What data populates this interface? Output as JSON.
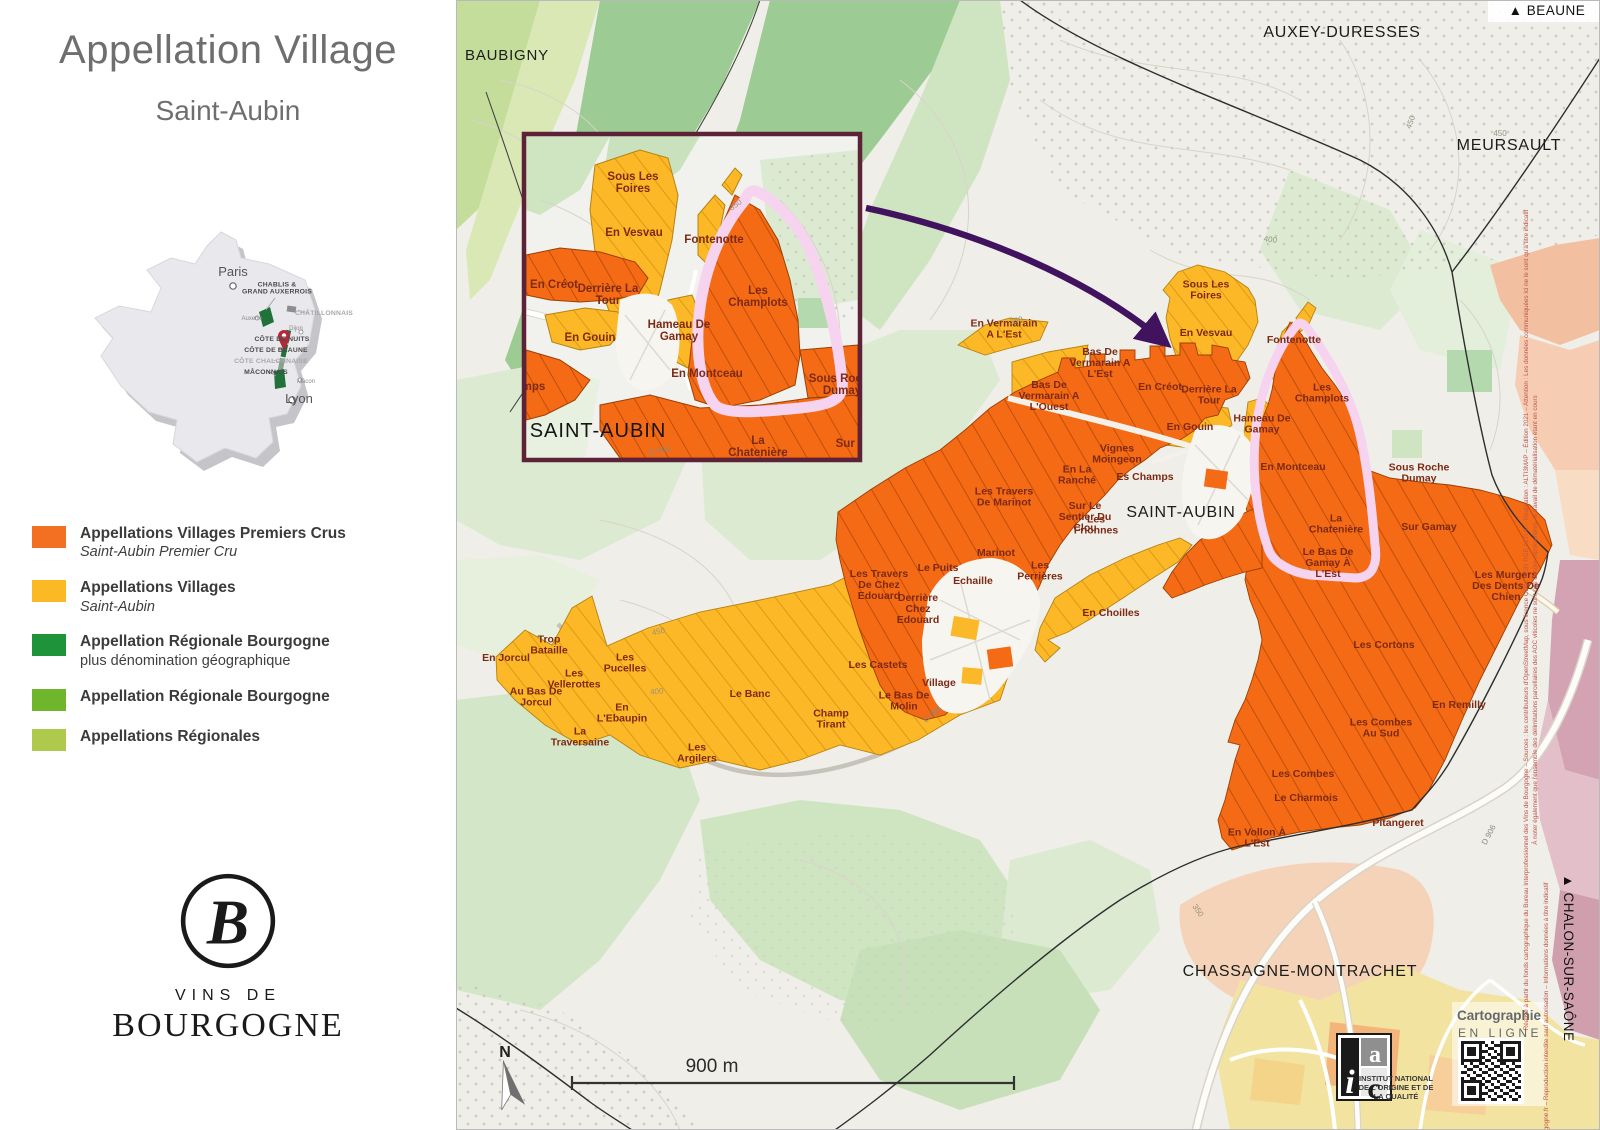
{
  "panel": {
    "title": "Appellation Village",
    "subtitle": "Saint-Aubin",
    "legend": [
      {
        "color": "#f36f21",
        "label": "Appellations Villages Premiers Crus",
        "sublabel": "Saint-Aubin Premier Cru"
      },
      {
        "color": "#fbba25",
        "label": "Appellations Villages",
        "sublabel": "Saint-Aubin"
      },
      {
        "color": "#1f9339",
        "label": "Appellation Régionale Bourgogne",
        "sublabel": "plus dénomination géographique"
      },
      {
        "color": "#70b62c",
        "label": "Appellation Régionale Bourgogne"
      },
      {
        "color": "#afc94c",
        "label": "Appellations Régionales"
      }
    ],
    "logo": {
      "initial": "B",
      "line1": "VINS DE",
      "line2": "BOURGOGNE"
    },
    "france": {
      "labels": [
        {
          "t": "Paris",
          "x": 160,
          "y": 58,
          "c": "fr-city"
        },
        {
          "t": "Lyon",
          "x": 226,
          "y": 185,
          "c": "fr-city",
          "a": "start"
        },
        {
          "t": "CHABLIS &\nGRAND AUXERROIS",
          "x": 204,
          "y": 72,
          "c": "fr-region"
        },
        {
          "t": "CHÂTILLONNAIS",
          "x": 251,
          "y": 97,
          "c": "fr-region fr-muted"
        },
        {
          "t": "Auxerre",
          "x": 179,
          "y": 102,
          "c": "fr-town",
          "a": "end"
        },
        {
          "t": "Dijon",
          "x": 223,
          "y": 112,
          "c": "fr-town",
          "a": "end"
        },
        {
          "t": "CÔTE DE NUITS",
          "x": 209,
          "y": 123,
          "c": "fr-region",
          "a": "end"
        },
        {
          "t": "CÔTE DE BEAUNE",
          "x": 203,
          "y": 134,
          "c": "fr-region",
          "a": "end"
        },
        {
          "t": "CÔTE CHALONNAISE",
          "x": 198,
          "y": 145,
          "c": "fr-region fr-muted",
          "a": "end"
        },
        {
          "t": "MÂCONNAIS",
          "x": 193,
          "y": 156,
          "c": "fr-region",
          "a": "end"
        },
        {
          "t": "Mâcon",
          "x": 233,
          "y": 165,
          "c": "fr-town",
          "a": "start"
        }
      ]
    }
  },
  "map": {
    "labels": [
      {
        "t": "BAUBIGNY",
        "x": 507,
        "y": 60,
        "c": "commune commune-sm"
      },
      {
        "t": "AUXEY-DURESSES",
        "x": 1342,
        "y": 37,
        "c": "commune"
      },
      {
        "t": "MEURSAULT",
        "x": 1509,
        "y": 150,
        "c": "commune"
      },
      {
        "t": "SAINT-AUBIN",
        "x": 1181,
        "y": 517,
        "c": "commune"
      },
      {
        "t": "CHASSAGNE-MONTRACHET",
        "x": 1300,
        "y": 976,
        "c": "commune"
      },
      {
        "t": "Sous Les\nFoires",
        "x": 1206,
        "y": 293,
        "c": "parcel"
      },
      {
        "t": "En Vesvau",
        "x": 1206,
        "y": 336,
        "c": "parcel"
      },
      {
        "t": "Fontenotte",
        "x": 1294,
        "y": 343,
        "c": "parcel"
      },
      {
        "t": "En Vermarain\nA L'Est",
        "x": 1004,
        "y": 332,
        "c": "parcel"
      },
      {
        "t": "Bas De\nVermarain A\nL'Ouest",
        "x": 1049,
        "y": 399,
        "c": "parcel"
      },
      {
        "t": "Bas De\nVermarain A\nL'Est",
        "x": 1100,
        "y": 366,
        "c": "parcel"
      },
      {
        "t": "En Créot",
        "x": 1160,
        "y": 390,
        "c": "parcel"
      },
      {
        "t": "Derrière La\nTour",
        "x": 1209,
        "y": 398,
        "c": "parcel"
      },
      {
        "t": "En Gouin",
        "x": 1190,
        "y": 430,
        "c": "parcel"
      },
      {
        "t": "Hameau De\nGamay",
        "x": 1262,
        "y": 427,
        "c": "parcel"
      },
      {
        "t": "Vignes\nMoingeon",
        "x": 1117,
        "y": 457,
        "c": "parcel"
      },
      {
        "t": "En La\nRanché",
        "x": 1077,
        "y": 478,
        "c": "parcel"
      },
      {
        "t": "Es Champs",
        "x": 1145,
        "y": 480,
        "c": "parcel"
      },
      {
        "t": "Les Travers\nDe Marinot",
        "x": 1004,
        "y": 500,
        "c": "parcel"
      },
      {
        "t": "Sur Le\nSentier Du\nClou",
        "x": 1085,
        "y": 520,
        "c": "parcel"
      },
      {
        "t": "Les\nFrionnes",
        "x": 1096,
        "y": 528,
        "c": "parcel"
      },
      {
        "t": "Marinot",
        "x": 996,
        "y": 556,
        "c": "parcel"
      },
      {
        "t": "Le Puits",
        "x": 938,
        "y": 571,
        "c": "parcel"
      },
      {
        "t": "Echaille",
        "x": 973,
        "y": 584,
        "c": "parcel"
      },
      {
        "t": "Les\nPerrières",
        "x": 1040,
        "y": 574,
        "c": "parcel"
      },
      {
        "t": "Les Travers\nDe Chez\nEdouard",
        "x": 879,
        "y": 588,
        "c": "parcel"
      },
      {
        "t": "Derrière\nChez\nEdouard",
        "x": 918,
        "y": 612,
        "c": "parcel"
      },
      {
        "t": "Les Castets",
        "x": 878,
        "y": 668,
        "c": "parcel"
      },
      {
        "t": "Village",
        "x": 939,
        "y": 686,
        "c": "parcel"
      },
      {
        "t": "Le Bas De\nMolin",
        "x": 904,
        "y": 704,
        "c": "parcel"
      },
      {
        "t": "En Choilles",
        "x": 1111,
        "y": 616,
        "c": "parcel"
      },
      {
        "t": "En Jorcul",
        "x": 506,
        "y": 661,
        "c": "parcel"
      },
      {
        "t": "Trop\nBataille",
        "x": 549,
        "y": 648,
        "c": "parcel"
      },
      {
        "t": "Les\nPucelles",
        "x": 625,
        "y": 666,
        "c": "parcel"
      },
      {
        "t": "Les\nVellerottes",
        "x": 574,
        "y": 682,
        "c": "parcel"
      },
      {
        "t": "Au Bas De\nJorcul",
        "x": 536,
        "y": 700,
        "c": "parcel"
      },
      {
        "t": "En\nL'Ebaupin",
        "x": 622,
        "y": 716,
        "c": "parcel"
      },
      {
        "t": "La\nTraversaine",
        "x": 580,
        "y": 740,
        "c": "parcel"
      },
      {
        "t": "Les\nArgilers",
        "x": 697,
        "y": 756,
        "c": "parcel"
      },
      {
        "t": "Le Banc",
        "x": 750,
        "y": 697,
        "c": "parcel"
      },
      {
        "t": "Champ\nTirant",
        "x": 831,
        "y": 722,
        "c": "parcel"
      },
      {
        "t": "Les\nChamplots",
        "x": 1322,
        "y": 396,
        "c": "parcel"
      },
      {
        "t": "En Montceau",
        "x": 1293,
        "y": 470,
        "c": "parcel"
      },
      {
        "t": "Sous Roche\nDumay",
        "x": 1419,
        "y": 476,
        "c": "parcel"
      },
      {
        "t": "La\nChatenière",
        "x": 1336,
        "y": 527,
        "c": "parcel"
      },
      {
        "t": "Sur Gamay",
        "x": 1429,
        "y": 530,
        "c": "parcel"
      },
      {
        "t": "Le Bas De\nGamay À\nL'Est",
        "x": 1328,
        "y": 566,
        "c": "parcel"
      },
      {
        "t": "Les Murgers\nDes Dents De\nChien",
        "x": 1506,
        "y": 589,
        "c": "parcel"
      },
      {
        "t": "Les Cortons",
        "x": 1384,
        "y": 648,
        "c": "parcel"
      },
      {
        "t": "En Remilly",
        "x": 1459,
        "y": 708,
        "c": "parcel"
      },
      {
        "t": "Les Combes\nAu Sud",
        "x": 1381,
        "y": 731,
        "c": "parcel"
      },
      {
        "t": "Les Combes",
        "x": 1303,
        "y": 777,
        "c": "parcel"
      },
      {
        "t": "Le Charmois",
        "x": 1306,
        "y": 801,
        "c": "parcel"
      },
      {
        "t": "Pitangeret",
        "x": 1398,
        "y": 826,
        "c": "parcel"
      },
      {
        "t": "En Vollon À\nL'Est",
        "x": 1257,
        "y": 841,
        "c": "parcel"
      },
      {
        "t": "350",
        "x": 1017,
        "y": 323,
        "c": "contour",
        "r": -15
      },
      {
        "t": "400",
        "x": 1270,
        "y": 242,
        "c": "contour",
        "r": 8
      },
      {
        "t": "450",
        "x": 1413,
        "y": 123,
        "c": "contour",
        "r": -70
      },
      {
        "t": "450",
        "x": 1500,
        "y": 136,
        "c": "contour"
      },
      {
        "t": "450",
        "x": 659,
        "y": 634,
        "c": "contour",
        "r": -12
      },
      {
        "t": "400",
        "x": 657,
        "y": 694,
        "c": "contour",
        "r": -5
      },
      {
        "t": "350",
        "x": 1196,
        "y": 912,
        "c": "contour",
        "r": 55
      },
      {
        "t": "D 906",
        "x": 934,
        "y": 716,
        "c": "road",
        "r": -38
      },
      {
        "t": "D 906",
        "x": 1491,
        "y": 836,
        "c": "road",
        "r": -62
      }
    ],
    "inset_labels": [
      {
        "t": "Sous Les\nFoires",
        "x": 633,
        "y": 186,
        "c": "iparcel"
      },
      {
        "t": "En Vesvau",
        "x": 634,
        "y": 236,
        "c": "iparcel"
      },
      {
        "t": "En Créot",
        "x": 554,
        "y": 288,
        "c": "iparcel"
      },
      {
        "t": "Derrière La\nTour",
        "x": 608,
        "y": 298,
        "c": "iparcel"
      },
      {
        "t": "En Gouin",
        "x": 590,
        "y": 341,
        "c": "iparcel"
      },
      {
        "t": "Es Champs",
        "x": 514,
        "y": 390,
        "c": "iparcel"
      },
      {
        "t": "Hameau De\nGamay",
        "x": 679,
        "y": 334,
        "c": "iparcel"
      },
      {
        "t": "Fontenotte",
        "x": 714,
        "y": 243,
        "c": "iparcel"
      },
      {
        "t": "Les\nChamplots",
        "x": 758,
        "y": 300,
        "c": "iparcel"
      },
      {
        "t": "En Montceau",
        "x": 707,
        "y": 377,
        "c": "iparcel"
      },
      {
        "t": "Sous Roche\nDumay",
        "x": 842,
        "y": 388,
        "c": "iparcel"
      },
      {
        "t": "La\nChatenière",
        "x": 758,
        "y": 450,
        "c": "iparcel"
      },
      {
        "t": "Sur Gamay",
        "x": 866,
        "y": 447,
        "c": "iparcel"
      },
      {
        "t": "SAINT-AUBIN",
        "x": 598,
        "y": 437,
        "c": "itown"
      },
      {
        "t": "350",
        "x": 737,
        "y": 207,
        "c": "contour",
        "r": -35
      },
      {
        "t": "D 906",
        "x": 660,
        "y": 453,
        "c": "road",
        "r": -10
      }
    ],
    "overlay_labels": [
      {
        "t": "▲ BEAUNE",
        "x": 1547,
        "y": 15,
        "c": "dir"
      },
      {
        "t": "▲ CHALON-SUR-SAÔNE",
        "x": 1564,
        "y": 958,
        "c": "dir",
        "r": 90,
        "a": "start"
      },
      {
        "t": "900 m",
        "x": 712,
        "y": 1072,
        "c": "scale"
      },
      {
        "t": "N",
        "x": 505,
        "y": 1057,
        "c": "nletter"
      },
      {
        "t": "Cartographie",
        "x": 1499,
        "y": 1020,
        "c": "carto1"
      },
      {
        "t": "EN LIGNE",
        "x": 1500,
        "y": 1037,
        "c": "carto2"
      },
      {
        "t": "INSTITUT NATIONAL",
        "x": 1396,
        "y": 1081,
        "c": "inao",
        "a": "start"
      },
      {
        "t": "DE L'ORIGINE ET DE",
        "x": 1396,
        "y": 1090,
        "c": "inao",
        "a": "start"
      },
      {
        "t": "LA QUALITÉ",
        "x": 1396,
        "y": 1099,
        "c": "inao",
        "a": "start"
      },
      {
        "t": "i",
        "x": 1350,
        "y": 1093,
        "c": "inao-i"
      },
      {
        "t": "a",
        "x": 1375,
        "y": 1062,
        "c": "inao-a"
      },
      {
        "t": "c",
        "x": 1374,
        "y": 1098,
        "c": "inao-c"
      },
      {
        "t": "Réalisé à partir du fonds cartographique du Bureau Interprofessionnel des Vins de Bourgogne – Sources : les contributeurs d'OpenStreetMap, sous licence ODbL / IGN RGE ALTI ® – Réalisation : ALTI3MAP – Édition 2021 – Attention : Les données communiquées ici ne le sont qu'à titre indicatif",
        "x": 1528,
        "y": 620,
        "c": "attrib",
        "r": -90
      },
      {
        "t": "À noter également que l'ensemble des délimitations parcellaires des AOC viticoles ne sont pas encore représentées, le travail de dématérialisation étant en cours",
        "x": 1537,
        "y": 620,
        "c": "attrib",
        "r": -90
      },
      {
        "t": "© www.vins-bourgogne.fr – Reproduction interdite sauf autorisation – Informations données à titre indicatif",
        "x": 1548,
        "y": 1030,
        "c": "attrib",
        "r": -90
      }
    ]
  }
}
